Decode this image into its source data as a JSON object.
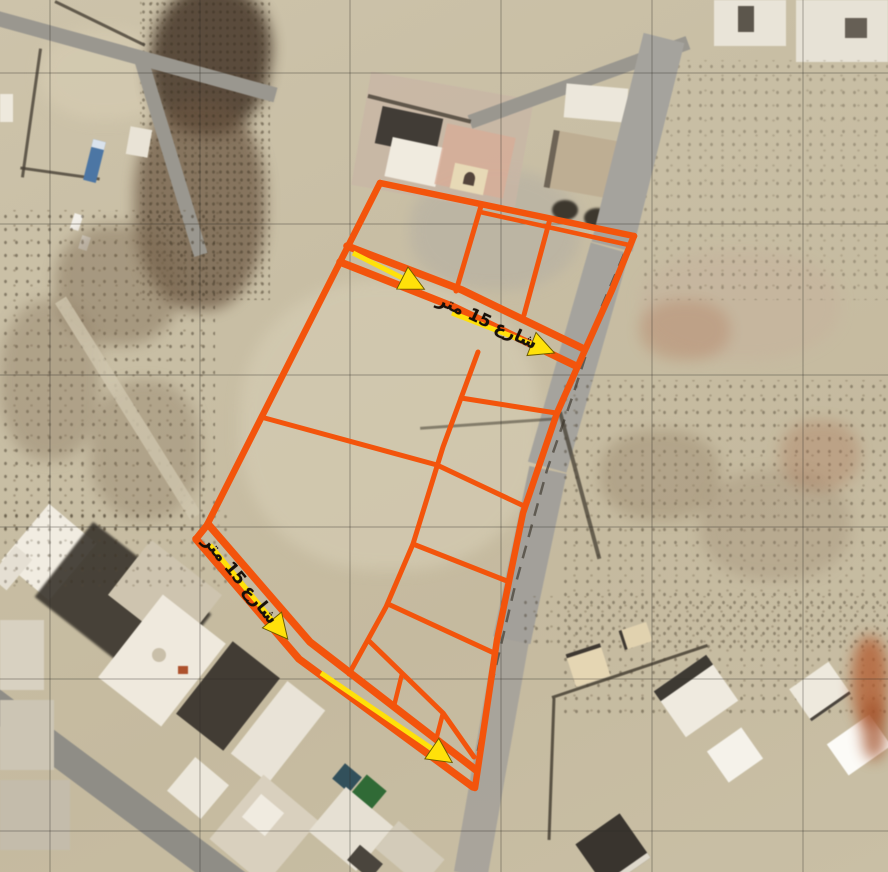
{
  "scene": {
    "type": "satellite-image-with-land-subdivision-plan",
    "description": "Aerial/satellite photo of desert town with an orange parcel subdivision overlay and yellow street measurement arrows"
  },
  "plan": {
    "outline_color": "#F3540C",
    "arrow_color": "#FFE10A",
    "label_color": "#17100A",
    "grid_color": "#2E2B26",
    "street_labels": [
      {
        "id": "top-street",
        "text": "شارع 15 متر"
      },
      {
        "id": "west-street",
        "text": "شارع 15 متر"
      }
    ]
  }
}
